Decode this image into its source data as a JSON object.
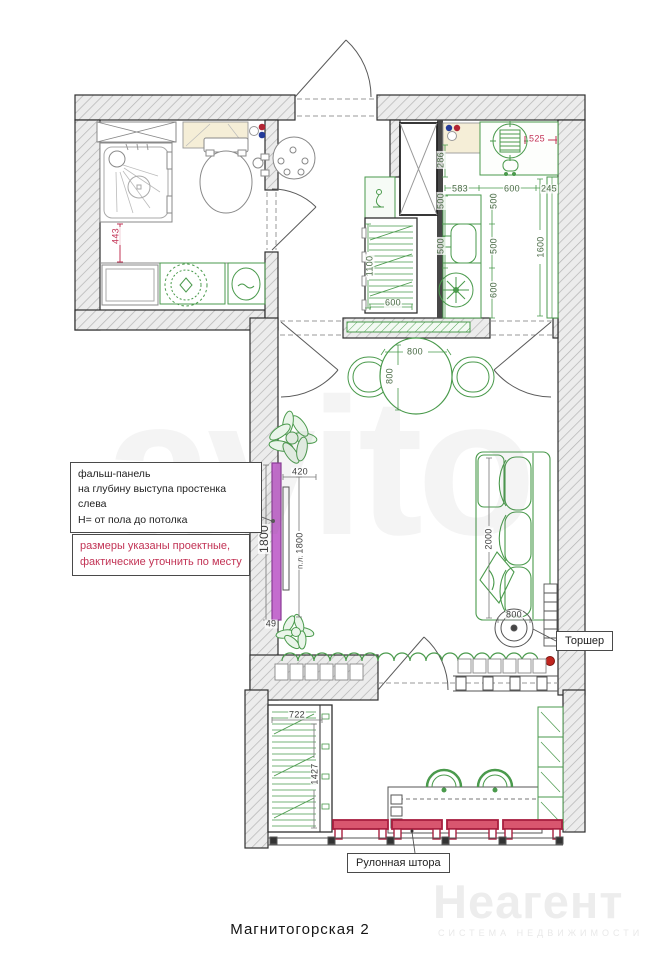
{
  "plan": {
    "title": "Магнитогорская 2",
    "annotations": {
      "panel_note_lines": [
        "фальш-панель",
        "на глубину выступа простенка слева",
        "Н= от пола до потолка"
      ],
      "sizes_note_lines": [
        "размеры указаны проектные,",
        "фактические уточнить по месту"
      ],
      "lamp_label": "Торшер",
      "blind_label": "Рулонная штора"
    },
    "watermarks": {
      "brand": "Неагент",
      "brand_tagline": "СИСТЕМА НЕДВИЖИМОСТИ",
      "background_brand": "avito"
    },
    "colors": {
      "furniture_green": "#4a9a4c",
      "wall_border": "#2f2f2f",
      "panel_purple": "#c46cce",
      "blind_red": "#a81f3f",
      "dim_red": "#c23355",
      "dim_green": "#4a6b46",
      "dim_dark": "#3c3c3c",
      "counter_beige": "#f5eed7"
    },
    "dims": [
      {
        "v": "443"
      },
      {
        "v": "525"
      },
      {
        "v": "286"
      },
      {
        "v": "583"
      },
      {
        "v": "600"
      },
      {
        "v": "245"
      },
      {
        "v": "500"
      },
      {
        "v": "500"
      },
      {
        "v": "500"
      },
      {
        "v": "500"
      },
      {
        "v": "600"
      },
      {
        "v": "1600"
      },
      {
        "v": "1100"
      },
      {
        "v": "600"
      },
      {
        "v": "800"
      },
      {
        "v": "800"
      },
      {
        "v": "420"
      },
      {
        "v": "1800"
      },
      {
        "v": "1800"
      },
      {
        "v": "п.л."
      },
      {
        "v": "49"
      },
      {
        "v": "2000"
      },
      {
        "v": "800"
      },
      {
        "v": "722"
      },
      {
        "v": "1427"
      }
    ]
  }
}
